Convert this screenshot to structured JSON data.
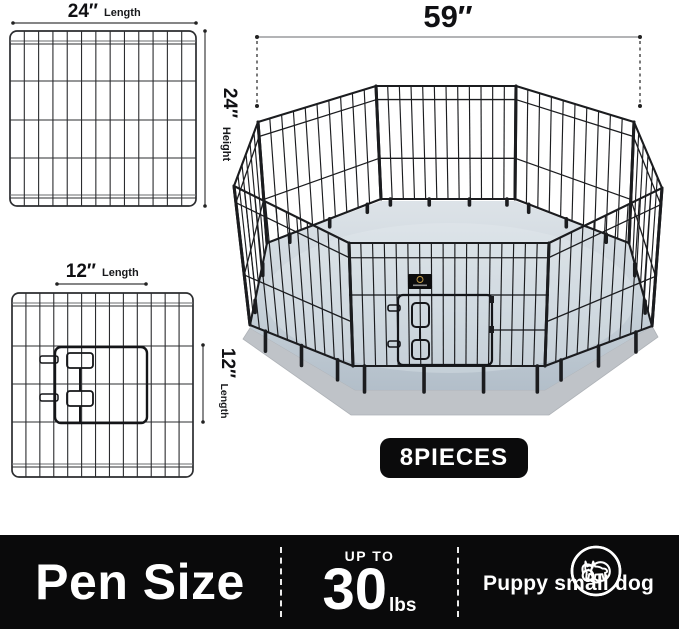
{
  "product_graphic": {
    "panel_large": {
      "length_value": "24″",
      "length_unit": "Length",
      "height_value": "24″",
      "height_unit": "Height"
    },
    "panel_door": {
      "length_value": "12″",
      "length_unit": "Length",
      "side_value": "12″",
      "side_unit": "Length"
    },
    "pen": {
      "width_label": "59″",
      "pieces_label": "8PIECES"
    },
    "info_bar": {
      "title": "Pen Size",
      "weight_prefix": "UP TO",
      "weight_value": "30",
      "weight_unit": "lbs",
      "pets_label": "Puppy small dog",
      "icons": [
        "puppy-icon",
        "small-dog-icon"
      ]
    },
    "colors": {
      "bar_black": "#0a0a0b",
      "wire": "#1b1c1f",
      "floor_light": "#dbe1e7",
      "floor_dark": "#b2bec9",
      "base_gray": "#bfc3c8"
    }
  }
}
